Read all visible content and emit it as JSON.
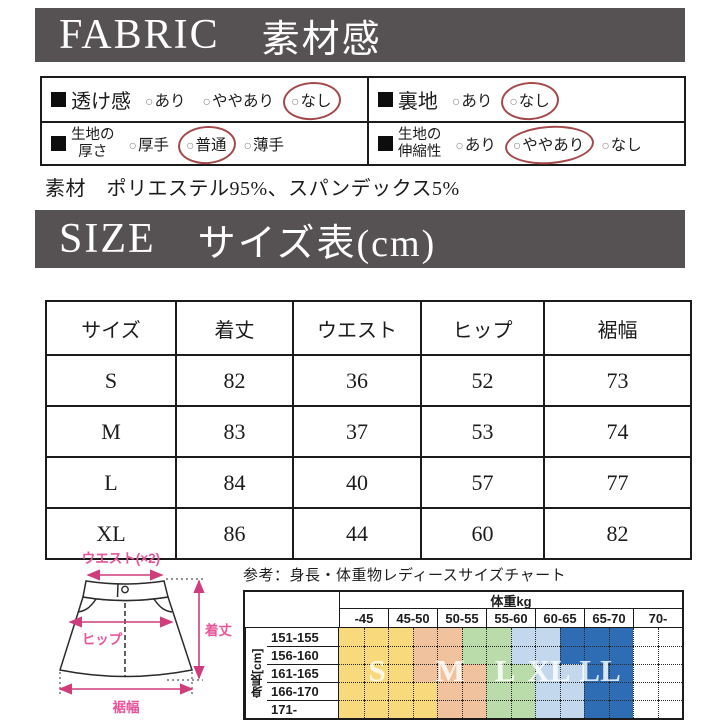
{
  "fabric_section": {
    "title_en": "FABRIC",
    "title_ja": "素材感",
    "bar_color": "#565254",
    "annotation_color": "#a4494b",
    "spec_rows": [
      {
        "label_lines": [
          "透け感"
        ],
        "options": [
          "あり",
          "ややあり",
          "なし"
        ],
        "selected_index": 2
      },
      {
        "label_lines": [
          "裏地"
        ],
        "options": [
          "あり",
          "なし"
        ],
        "selected_index": 1
      },
      {
        "label_lines": [
          "生地の",
          "厚さ"
        ],
        "options": [
          "厚手",
          "普通",
          "薄手"
        ],
        "selected_index": 1
      },
      {
        "label_lines": [
          "生地の",
          "伸縮性"
        ],
        "options": [
          "あり",
          "ややあり",
          "なし"
        ],
        "selected_index": 1
      }
    ],
    "option_mark": "○",
    "material_text": "素材　ポリエステル95%、スパンデックス5%"
  },
  "size_section": {
    "title_en": "SIZE",
    "title_ja": "サイズ表(cm)",
    "table": {
      "columns": [
        "サイズ",
        "着丈",
        "ウエスト",
        "ヒップ",
        "裾幅"
      ],
      "rows": [
        [
          "S",
          "82",
          "36",
          "52",
          "73"
        ],
        [
          "M",
          "83",
          "37",
          "53",
          "74"
        ],
        [
          "L",
          "84",
          "40",
          "57",
          "77"
        ],
        [
          "XL",
          "86",
          "44",
          "60",
          "82"
        ]
      ]
    }
  },
  "diagram": {
    "waist_label": "ウエスト(×2)",
    "hip_label": "ヒップ",
    "length_label": "着丈",
    "hem_label": "裾幅",
    "accent_color": "#cf3d7c",
    "label_color": "#e8559b"
  },
  "chart_data": {
    "type": "heatmap",
    "title": "参考：身長・体重物レディースサイズチャート",
    "col_group_label": "体重kg",
    "row_group_label": "身長[cm]",
    "columns": [
      "-45",
      "45-50",
      "50-55",
      "55-60",
      "60-65",
      "65-70",
      "70-"
    ],
    "rows": [
      "151-155",
      "156-160",
      "161-165",
      "166-170",
      "171-"
    ],
    "size_labels": [
      "S",
      "M",
      "L",
      "XL",
      "LL"
    ],
    "legend_colors": {
      "S": "#f8da7d",
      "M": "#f1c29e",
      "L": "#badcab",
      "XL": "#c3d8ed",
      "LL": "#2e6db4",
      "none": "#ffffff"
    },
    "cells": [
      [
        "S",
        "S",
        "S",
        "M",
        "M",
        "L",
        "L",
        "XL",
        "XL",
        "LL",
        "LL",
        "LL",
        "",
        ""
      ],
      [
        "S",
        "S",
        "S",
        "M",
        "M",
        "L",
        "L",
        "XL",
        "XL",
        "LL",
        "LL",
        "LL",
        "",
        ""
      ],
      [
        "S",
        "S",
        "S",
        "M",
        "M",
        "M",
        "L",
        "L",
        "XL",
        "XL",
        "LL",
        "LL",
        "",
        ""
      ],
      [
        "S",
        "S",
        "S",
        "S",
        "M",
        "M",
        "L",
        "L",
        "XL",
        "XL",
        "LL",
        "LL",
        "",
        ""
      ],
      [
        "S",
        "S",
        "S",
        "S",
        "M",
        "M",
        "L",
        "L",
        "XL",
        "XL",
        "LL",
        "LL",
        "",
        ""
      ]
    ],
    "layout": {
      "half_columns_per_weight_column": 2,
      "grid": "dotted",
      "letter_x_percents": [
        11.7,
        33,
        49,
        61.8,
        76.7
      ]
    }
  }
}
